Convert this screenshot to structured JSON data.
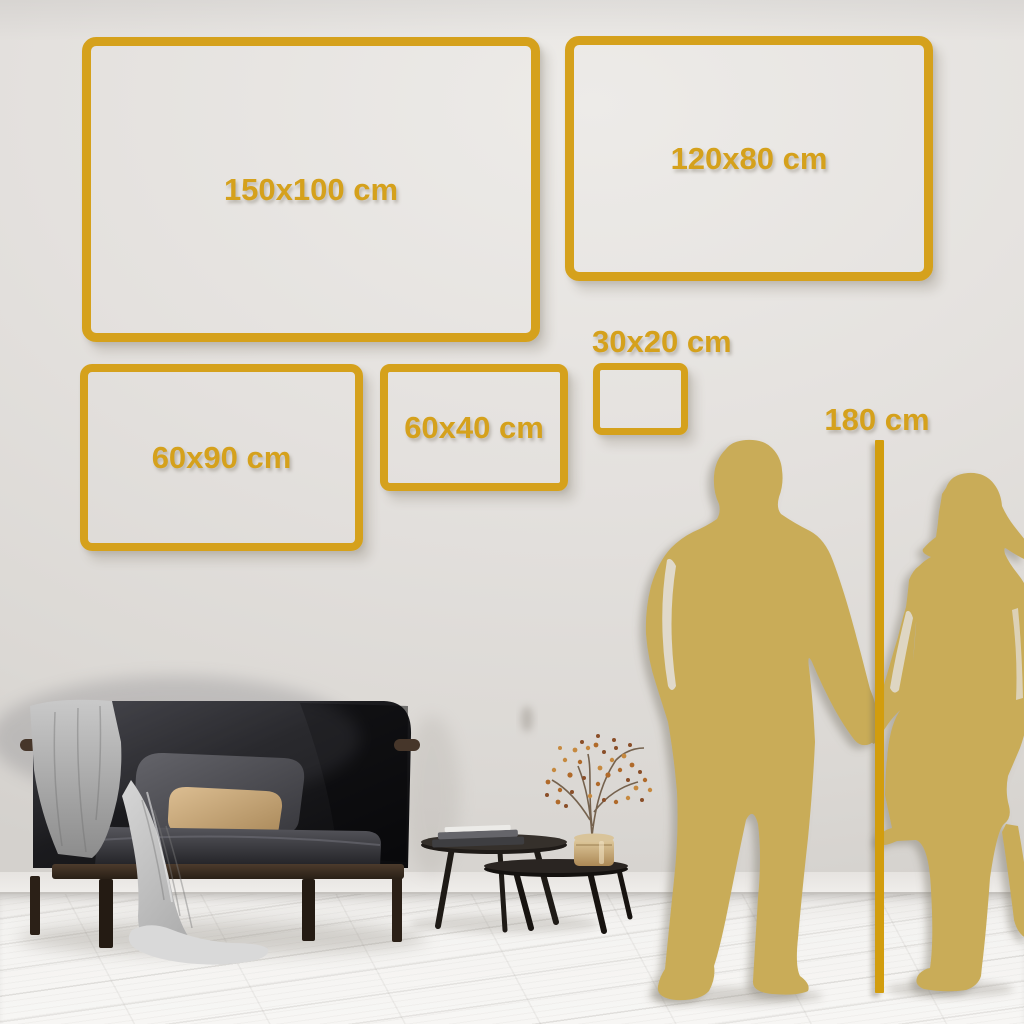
{
  "frames": [
    {
      "label": "150x100 cm",
      "width_cm": 150,
      "height_cm": 100
    },
    {
      "label": "120x80 cm",
      "width_cm": 120,
      "height_cm": 80
    },
    {
      "label": "60x90 cm",
      "width_cm": 60,
      "height_cm": 90
    },
    {
      "label": "60x40 cm",
      "width_cm": 60,
      "height_cm": 40
    },
    {
      "label": "30x20 cm",
      "width_cm": 30,
      "height_cm": 20
    }
  ],
  "height_reference": {
    "label": "180 cm",
    "value_cm": 180
  },
  "palette": {
    "accent_gold": "#D5A11C",
    "ruler_gold": "#D29D0E",
    "silhouette_gold": "#C9AC58",
    "wall": "#E4E1DE",
    "floor": "#F3F2F0"
  },
  "scene": {
    "silhouette_left": "man",
    "silhouette_right": "woman",
    "furniture": [
      "dark sofa with gray throw blanket and pillows",
      "two nesting coffee tables",
      "stack of books",
      "brass vase with dried flower branch"
    ]
  }
}
